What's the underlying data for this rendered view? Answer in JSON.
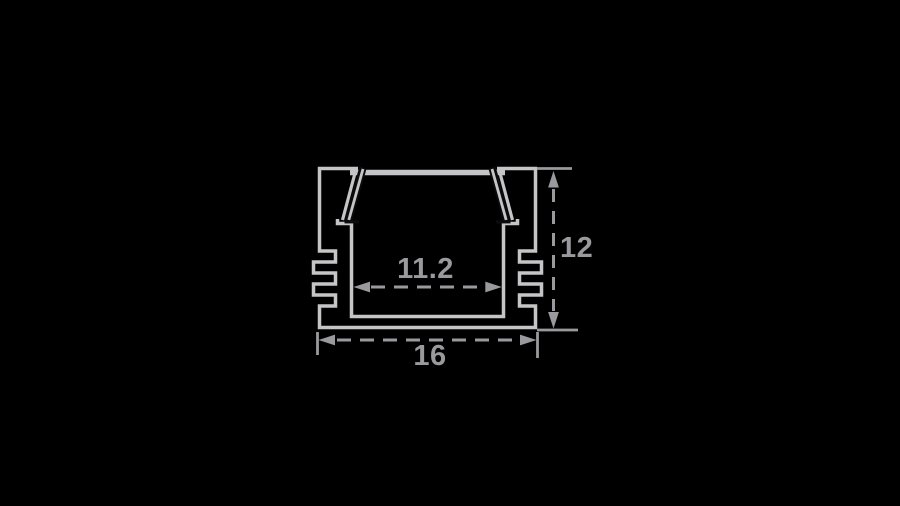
{
  "diagram": {
    "kind": "profile-cross-section",
    "dimensions": {
      "inner_width": "11.2",
      "outer_width": "16",
      "height": "12"
    }
  },
  "colors": {
    "background": "#000000",
    "profile_line": "#c5c5c8",
    "cover_edge": "#0b0b0b",
    "dimension": "#9a9a9e"
  }
}
